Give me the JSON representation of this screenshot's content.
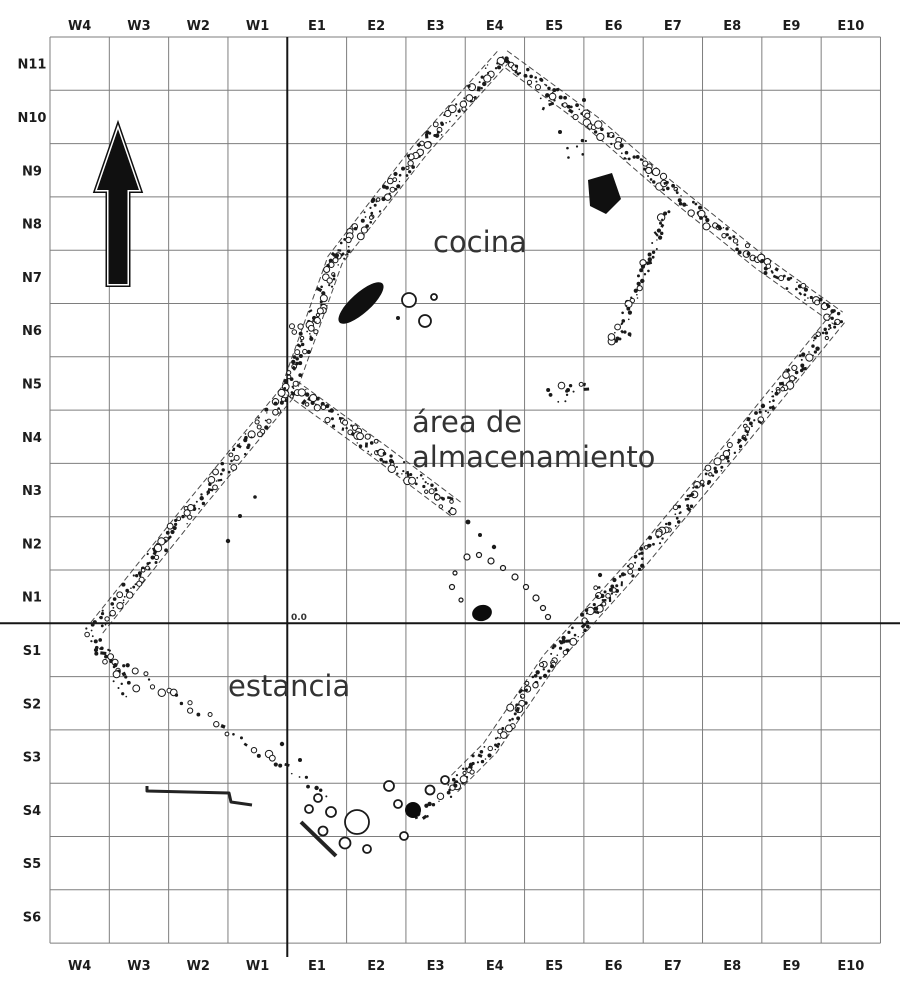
{
  "grid": {
    "col_labels": [
      "W4",
      "W3",
      "W2",
      "W1",
      "E1",
      "E2",
      "E3",
      "E4",
      "E5",
      "E6",
      "E7",
      "E8",
      "E9",
      "E10"
    ],
    "row_labels": [
      "N11",
      "N10",
      "N9",
      "N8",
      "N7",
      "N6",
      "N5",
      "N4",
      "N3",
      "N2",
      "N1",
      "S1",
      "S2",
      "S3",
      "S4",
      "S5",
      "S6"
    ],
    "origin_label": "0.0",
    "colors": {
      "grid_line": "#7e7e7e",
      "axis_line": "#151515",
      "label_color": "#1c1c1c",
      "wall_color": "#1a1a1a",
      "room_label_color": "#333333"
    }
  },
  "north_arrow": {
    "direction": "up"
  },
  "plan": {
    "room_labels": [
      {
        "id": "cocina",
        "lines": [
          "cocina"
        ],
        "x": 433,
        "y": 252,
        "line_height": 35
      },
      {
        "id": "almacenamiento",
        "lines": [
          "área de",
          "almacenamiento"
        ],
        "x": 412,
        "y": 432,
        "line_height": 35
      },
      {
        "id": "estancia",
        "lines": [
          "estancia"
        ],
        "x": 228,
        "y": 696,
        "line_height": 35
      }
    ],
    "walls": [
      {
        "id": "nw-wall",
        "points": [
          [
            503,
            57
          ],
          [
            420,
            150
          ],
          [
            335,
            260
          ],
          [
            288,
            392
          ],
          [
            195,
            505
          ],
          [
            95,
            630
          ]
        ],
        "width": 13,
        "spacing": 2.3,
        "faces": true
      },
      {
        "id": "ne-wall",
        "points": [
          [
            503,
            57
          ],
          [
            593,
            123
          ],
          [
            667,
            187
          ],
          [
            760,
            262
          ],
          [
            838,
            318
          ]
        ],
        "width": 12,
        "spacing": 2.6,
        "faces": true
      },
      {
        "id": "se-wall",
        "points": [
          [
            838,
            318
          ],
          [
            735,
            445
          ],
          [
            640,
            560
          ],
          [
            550,
            660
          ],
          [
            490,
            748
          ],
          [
            450,
            788
          ]
        ],
        "width": 13,
        "spacing": 2.4,
        "faces": true
      },
      {
        "id": "sw-wall",
        "points": [
          [
            98,
            648
          ],
          [
            180,
            700
          ],
          [
            260,
            752
          ],
          [
            330,
            797
          ]
        ],
        "width": 9,
        "spacing": 7,
        "faces": false
      },
      {
        "id": "partition-cocina",
        "points": [
          [
            292,
            388
          ],
          [
            380,
            452
          ],
          [
            457,
            510
          ]
        ],
        "width": 14,
        "spacing": 2.2,
        "faces": true
      },
      {
        "id": "partition-ne",
        "points": [
          [
            668,
            212
          ],
          [
            640,
            280
          ],
          [
            614,
            344
          ]
        ],
        "width": 10,
        "spacing": 3,
        "faces": false
      },
      {
        "id": "west-corner-rubble",
        "points": [
          [
            88,
            628
          ],
          [
            112,
            668
          ],
          [
            132,
            695
          ]
        ],
        "width": 15,
        "spacing": 2.6,
        "faces": false
      },
      {
        "id": "south-corner-rubble",
        "points": [
          [
            470,
            770
          ],
          [
            445,
            795
          ],
          [
            415,
            822
          ]
        ],
        "width": 12,
        "spacing": 4.5,
        "faces": false
      }
    ],
    "features": {
      "hearth": {
        "cx": 361,
        "cy": 303,
        "rx": 29,
        "ry": 10,
        "rot": -42
      },
      "wall_blob": {
        "points": [
          [
            588,
            180
          ],
          [
            612,
            173
          ],
          [
            621,
            199
          ],
          [
            606,
            214
          ],
          [
            590,
            206
          ]
        ]
      },
      "post_dots": [
        {
          "cx": 482,
          "cy": 613,
          "rx": 10,
          "ry": 8,
          "rot": -15
        },
        {
          "cx": 413,
          "cy": 810,
          "rx": 8,
          "ry": 8,
          "rot": 0
        }
      ],
      "pots": [
        [
          357,
          822,
          12
        ],
        [
          331,
          812,
          5
        ],
        [
          318,
          798,
          4
        ],
        [
          309,
          809,
          4
        ],
        [
          323,
          831,
          4.5
        ],
        [
          345,
          843,
          5.5
        ],
        [
          367,
          849,
          4
        ],
        [
          389,
          786,
          5
        ],
        [
          398,
          804,
          4
        ],
        [
          404,
          836,
          4
        ],
        [
          430,
          790,
          4.5
        ],
        [
          445,
          780,
          4
        ],
        [
          409,
          300,
          7
        ],
        [
          425,
          321,
          6
        ],
        [
          434,
          297,
          3
        ]
      ],
      "arc_stones": [
        [
          467,
          557,
          3
        ],
        [
          479,
          555,
          2.5
        ],
        [
          491,
          561,
          3
        ],
        [
          503,
          568,
          2.5
        ],
        [
          515,
          577,
          3
        ],
        [
          526,
          587,
          2.5
        ],
        [
          536,
          598,
          3
        ],
        [
          543,
          608,
          2.5
        ],
        [
          548,
          617,
          2.5
        ],
        [
          455,
          573,
          2
        ],
        [
          452,
          587,
          2.5
        ],
        [
          461,
          600,
          2
        ]
      ],
      "clusters": [
        {
          "x": 570,
          "y": 392,
          "rx": 24,
          "ry": 15,
          "n": 14
        },
        {
          "x": 548,
          "y": 100,
          "rx": 14,
          "ry": 10,
          "n": 5
        },
        {
          "x": 572,
          "y": 150,
          "rx": 20,
          "ry": 16,
          "n": 6
        },
        {
          "x": 598,
          "y": 590,
          "rx": 14,
          "ry": 18,
          "n": 7
        },
        {
          "x": 620,
          "y": 338,
          "rx": 12,
          "ry": 9,
          "n": 6
        },
        {
          "x": 300,
          "y": 330,
          "rx": 10,
          "ry": 12,
          "n": 5
        }
      ],
      "dots": [
        [
          240,
          516,
          2
        ],
        [
          228,
          541,
          2.2
        ],
        [
          255,
          497,
          1.8
        ],
        [
          468,
          522,
          2.4
        ],
        [
          480,
          535,
          2
        ],
        [
          494,
          547,
          2.2
        ],
        [
          584,
          100,
          2
        ],
        [
          560,
          132,
          2
        ],
        [
          300,
          760,
          2
        ],
        [
          282,
          744,
          2.2
        ],
        [
          433,
          297,
          2.5
        ],
        [
          398,
          318,
          2
        ]
      ],
      "wall_lines": [
        {
          "id": "s4-wall-segment",
          "d": [
            [
              147,
              786
            ],
            [
              147,
              791
            ],
            [
              229,
              793
            ],
            [
              231,
              802
            ],
            [
              252,
              805
            ]
          ],
          "w": 3
        },
        {
          "id": "sw-wall-fragment",
          "d": [
            [
              301,
              822
            ],
            [
              336,
              856
            ]
          ],
          "w": 4
        }
      ]
    }
  }
}
